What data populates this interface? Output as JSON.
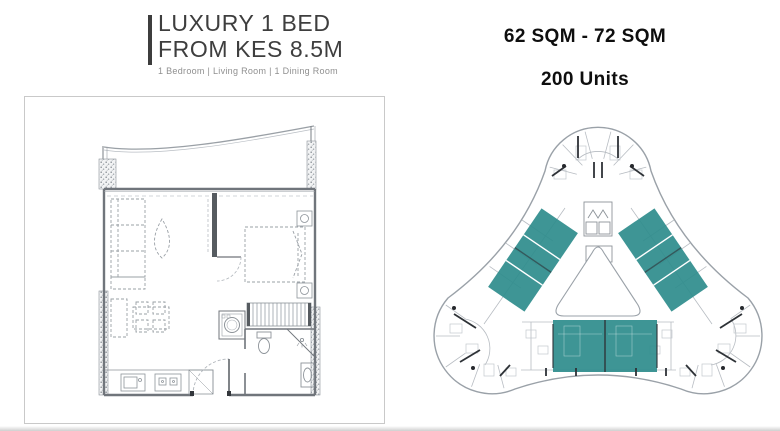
{
  "header": {
    "title_line1": "LUXURY 1 BED",
    "title_line2": "FROM KES 8.5M",
    "subtitle": "1 Bedroom | Living Room | 1 Dining Room"
  },
  "stats": {
    "area_range": "62 SQM - 72 SQM",
    "units_count": "200 Units"
  },
  "floor_plan_panel": {
    "label": "1-bed apartment floor plan"
  },
  "building_plate": {
    "label": "tri-lobe tower floor plate with highlighted 1-bed units",
    "highlight_color": "#2e8c8c"
  },
  "colors": {
    "background": "#ffffff",
    "panel_border": "#c9c9c9",
    "accent_bar": "#3d3d3d",
    "title_text": "#3e3e3e",
    "subtitle_text": "#8f8f8f",
    "stats_text": "#0e0e0e",
    "plan_linework": "#8f959b",
    "highlight_teal": "#2e8c8c"
  }
}
